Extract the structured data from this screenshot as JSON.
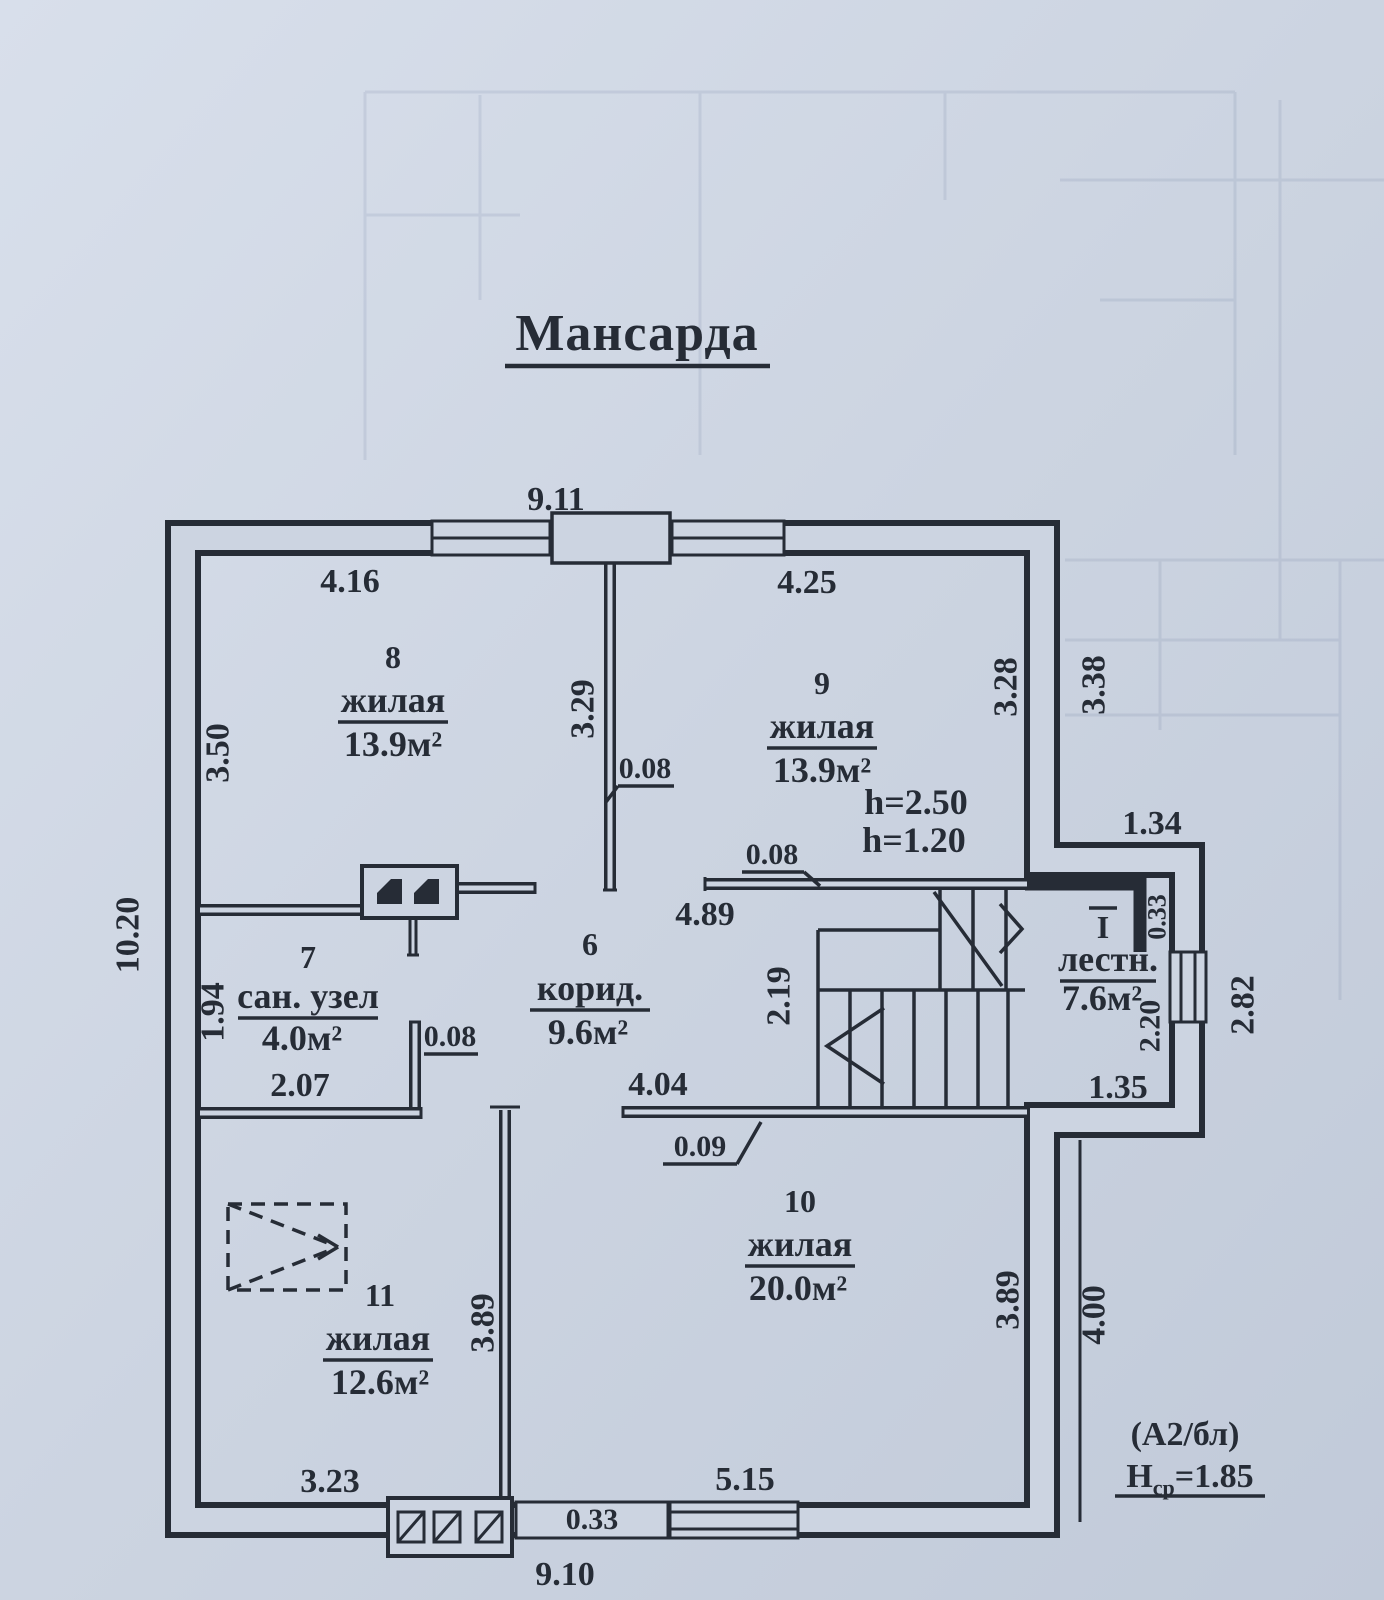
{
  "title": "Мансарда",
  "rooms": {
    "r8": {
      "num": "8",
      "name": "жилая",
      "area": "13.9м²"
    },
    "r9": {
      "num": "9",
      "name": "жилая",
      "area": "13.9м²",
      "h1": "h=2.50",
      "h2": "h=1.20"
    },
    "r6": {
      "num": "6",
      "name": "корид.",
      "area": "9.6м²"
    },
    "r7": {
      "num": "7",
      "name": "сан. узел",
      "area": "4.0м²"
    },
    "r10": {
      "num": "10",
      "name": "жилая",
      "area": "20.0м²"
    },
    "r11": {
      "num": "11",
      "name": "жилая",
      "area": "12.6м²"
    },
    "stairs": {
      "num": "I",
      "name": "лестн.",
      "area": "7.6м²"
    }
  },
  "dims": {
    "top_overall": "9.11",
    "room8_top": "4.16",
    "room9_top": "4.25",
    "room8_left": "3.50",
    "left_overall": "10.20",
    "room8_right": "3.29",
    "wall_008_a": "0.08",
    "room9_right": "3.28",
    "right_upper": "3.38",
    "wall_008_b": "0.08",
    "room9_bottom": "4.89",
    "bay_top": "1.34",
    "bay_niche": "0.33",
    "stair_window": "2.20",
    "bay_right": "2.82",
    "stair_bottom": "1.35",
    "stair_width": "2.19",
    "san_left": "1.94",
    "san_bottom": "2.07",
    "wall_008_c": "0.08",
    "corridor_bottom": "4.04",
    "wall_009": "0.09",
    "room11_right": "3.89",
    "room10_right": "3.89",
    "right_lower": "4.00",
    "room11_bottom": "3.23",
    "room10_bottom": "5.15",
    "bottom_niche": "0.33",
    "bottom_overall": "9.10"
  },
  "annotations": {
    "block": "(А2/бл)",
    "avg_height_symbol": "Н",
    "avg_height_sub": "ср",
    "avg_height_value": "=1.85"
  },
  "colors": {
    "paper": "#ccd4e1",
    "ink": "#262c36"
  }
}
